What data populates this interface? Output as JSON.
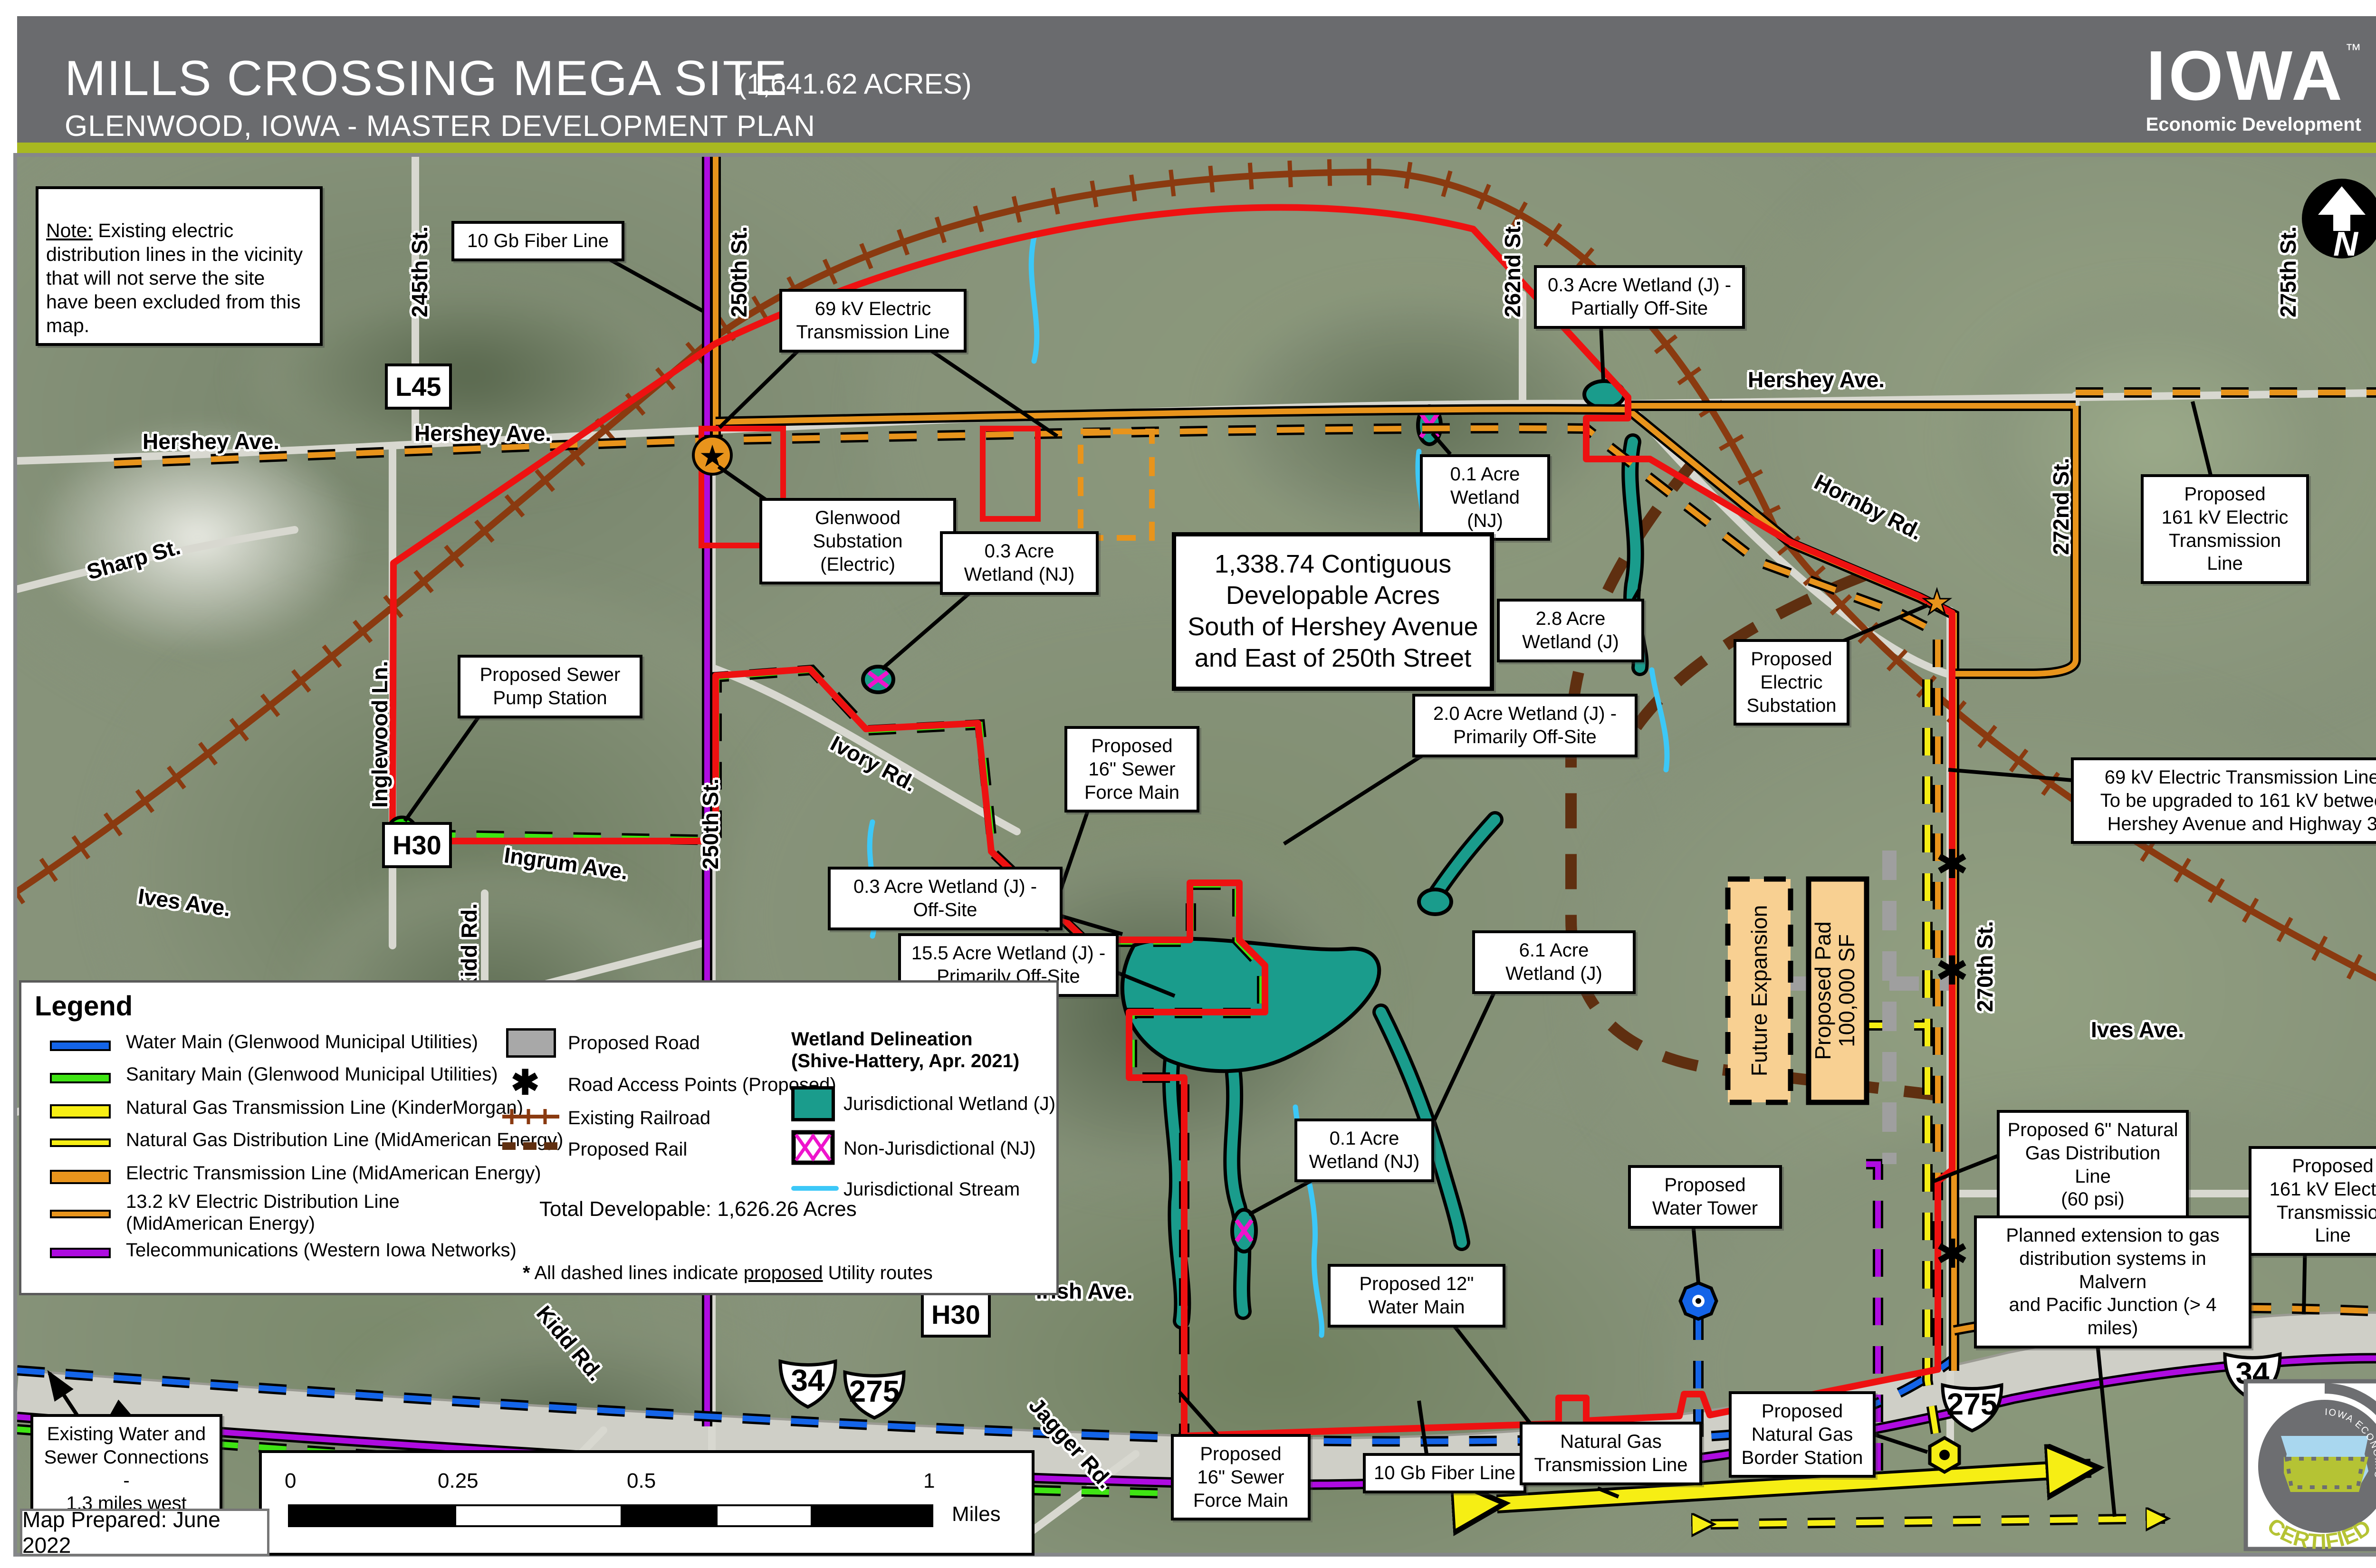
{
  "header": {
    "title": "MILLS CROSSING MEGA SITE",
    "acreage": "(1,641.62 ACRES)",
    "subtitle": "GLENWOOD, IOWA - MASTER DEVELOPMENT PLAN",
    "brand": {
      "name": "IOWA",
      "tm": "™",
      "tagline": "Economic Development"
    }
  },
  "note": {
    "label": "Note:",
    "text": " Existing electric distribution lines in the vicinity that will not serve the site have been excluded from this map."
  },
  "developable_box": "1,338.74 Contiguous\nDevelopable Acres\nSouth of Hershey Avenue\nand East of 250th Street",
  "callouts": [
    {
      "text": "10 Gb Fiber Line"
    },
    {
      "text": "69 kV Electric\nTransmission Line"
    },
    {
      "text": "Glenwood Substation\n(Electric)"
    },
    {
      "text": "0.3 Acre\nWetland (NJ)"
    },
    {
      "text": "0.3 Acre Wetland (J) -\nPartially Off-Site"
    },
    {
      "text": "0.1 Acre\nWetland (NJ)"
    },
    {
      "text": "2.8 Acre\nWetland (J)"
    },
    {
      "text": "Proposed\nElectric\nSubstation"
    },
    {
      "text": "Proposed\n161 kV Electric\nTransmission Line"
    },
    {
      "text": "69 kV Electric Transmission Line -\nTo be upgraded to 161 kV between\nHershey Avenue and Highway 34"
    },
    {
      "text": "Proposed Sewer\nPump Station"
    },
    {
      "text": "Proposed\n16\" Sewer\nForce Main"
    },
    {
      "text": "2.0 Acre Wetland (J) -\nPrimarily Off-Site"
    },
    {
      "text": "0.3 Acre Wetland (J) - Off-Site"
    },
    {
      "text": "15.5 Acre Wetland (J) -\nPrimarily Off-Site"
    },
    {
      "text": "6.1 Acre\nWetland (J)"
    },
    {
      "text": "0.1 Acre\nWetland (NJ)"
    },
    {
      "text": "Proposed 12\"\nWater Main"
    },
    {
      "text": "Proposed\nWater Tower"
    },
    {
      "text": "Proposed\n16\" Sewer\nForce Main"
    },
    {
      "text": "10 Gb Fiber Line"
    },
    {
      "text": "Natural Gas\nTransmission Line"
    },
    {
      "text": "Proposed\nNatural Gas\nBorder Station"
    },
    {
      "text": "Proposed 6\" Natural\nGas Distribution Line\n(60 psi)"
    },
    {
      "text": "Planned extension to gas\ndistribution systems in Malvern\nand Pacific Junction (> 4 miles)"
    },
    {
      "text": "Proposed\n161 kV Electric\nTransmission Line"
    },
    {
      "text": "Existing Water and\nSewer Connections -\n1.3 miles west"
    }
  ],
  "road_labels": [
    {
      "text": "245th St."
    },
    {
      "text": "250th St."
    },
    {
      "text": "250th St."
    },
    {
      "text": "262nd St."
    },
    {
      "text": "275th St."
    },
    {
      "text": "272nd St."
    },
    {
      "text": "270th St."
    },
    {
      "text": "Hershey Ave."
    },
    {
      "text": "Hershey Ave."
    },
    {
      "text": "Hershey Ave."
    },
    {
      "text": "Hornby Rd."
    },
    {
      "text": "Sharp St."
    },
    {
      "text": "Inglewood Ln."
    },
    {
      "text": "Ivory Rd."
    },
    {
      "text": "Ingrum Ave."
    },
    {
      "text": "Ives Ave."
    },
    {
      "text": "Kidd Rd."
    },
    {
      "text": "Ives Ave."
    },
    {
      "text": "Irish Ave."
    },
    {
      "text": "Kidd Rd."
    },
    {
      "text": "Jagger Rd."
    }
  ],
  "signs": [
    {
      "text": "L45"
    },
    {
      "text": "H30"
    },
    {
      "text": "H30"
    }
  ],
  "shields": [
    {
      "num": "34"
    },
    {
      "num": "275"
    },
    {
      "num": "275"
    },
    {
      "num": "34"
    }
  ],
  "pads": {
    "future": "Future Expansion",
    "pad": "Proposed Pad\n100,000 SF"
  },
  "north": "N",
  "legend": {
    "title": "Legend",
    "items": [
      {
        "label": "Water Main (Glenwood Municipal Utilities)"
      },
      {
        "label": "Sanitary Main (Glenwood Municipal Utilities)"
      },
      {
        "label": "Natural Gas Transmission Line (KinderMorgan)"
      },
      {
        "label": "Natural Gas Distribution Line (MidAmerican Energy)"
      },
      {
        "label": "Electric Transmission Line (MidAmerican Energy)"
      },
      {
        "label": "13.2 kV Electric Distribution Line\n(MidAmerican Energy)"
      },
      {
        "label": "Telecommunications (Western Iowa Networks)"
      }
    ],
    "items2": [
      {
        "label": "Proposed Road"
      },
      {
        "label": "Road Access Points (Proposed)"
      },
      {
        "label": "Existing Railroad"
      },
      {
        "label": "Proposed Rail"
      }
    ],
    "wetland_heading": "Wetland Delineation\n(Shive-Hattery, Apr. 2021)",
    "items3": [
      {
        "label": "Jurisdictional Wetland (J)"
      },
      {
        "label": "Non-Jurisdictional (NJ)"
      },
      {
        "label": "Jurisdictional Stream"
      }
    ],
    "total": "Total Developable: 1,626.26 Acres",
    "footnote_star": "*",
    "footnote_pre": " All dashed lines indicate ",
    "footnote_underline": "proposed",
    "footnote_post": " Utility routes"
  },
  "scalebar": {
    "ticks": [
      "0",
      "0.25",
      "0.5",
      "1"
    ],
    "unit": "Miles"
  },
  "map_prepared": "Map Prepared: June 2022",
  "badge": {
    "arc_top": "IOWA ECONOMIC DEVELOPMENT AUTHORITY",
    "arc_main": "CERTIFIED SITE"
  },
  "colors": {
    "hdr": "#6a6b6e",
    "lime": "#a8b821",
    "red": "#ee1111",
    "orange": "#e8941c",
    "yellow": "#f6ee14",
    "green": "#3fe414",
    "water": "#1464e8",
    "purple": "#ae0ce0",
    "rr": "#8a3a10",
    "railp": "#5f2f10",
    "teal": "#1a9c8c",
    "cyan": "#3cc8f8",
    "magenta": "#ee14cc",
    "tan": "#f8d092"
  }
}
